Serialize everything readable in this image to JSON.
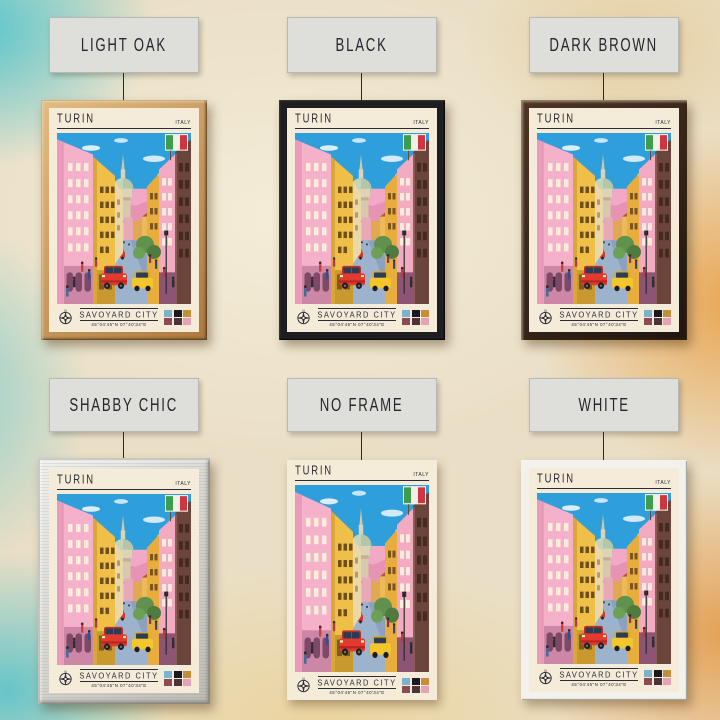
{
  "frames": [
    {
      "id": "light-oak",
      "label": "LIGHT OAK",
      "frame_color": "#c08b4e"
    },
    {
      "id": "black",
      "label": "BLACK",
      "frame_color": "#1e1e20"
    },
    {
      "id": "dark-brown",
      "label": "DARK BROWN",
      "frame_color": "#30211a"
    },
    {
      "id": "shabby-chic",
      "label": "SHABBY CHIC",
      "frame_color": "#d7d5ce"
    },
    {
      "id": "no-frame",
      "label": "NO FRAME",
      "frame_color": "none"
    },
    {
      "id": "white",
      "label": "WHITE",
      "frame_color": "#f3f1ec"
    }
  ],
  "poster": {
    "title": "TURIN",
    "country": "ITALY",
    "subtitle": "SAVOYARD CITY",
    "coordinates": "45°04'45\"N 07°40'34\"E",
    "paper_color": "#f4ecd9",
    "palette": [
      "#7ab4cc",
      "#1c1820",
      "#c58e3a",
      "#8c4a54",
      "#4c323a",
      "#e4a2b4"
    ],
    "flag": "italy-flag"
  }
}
